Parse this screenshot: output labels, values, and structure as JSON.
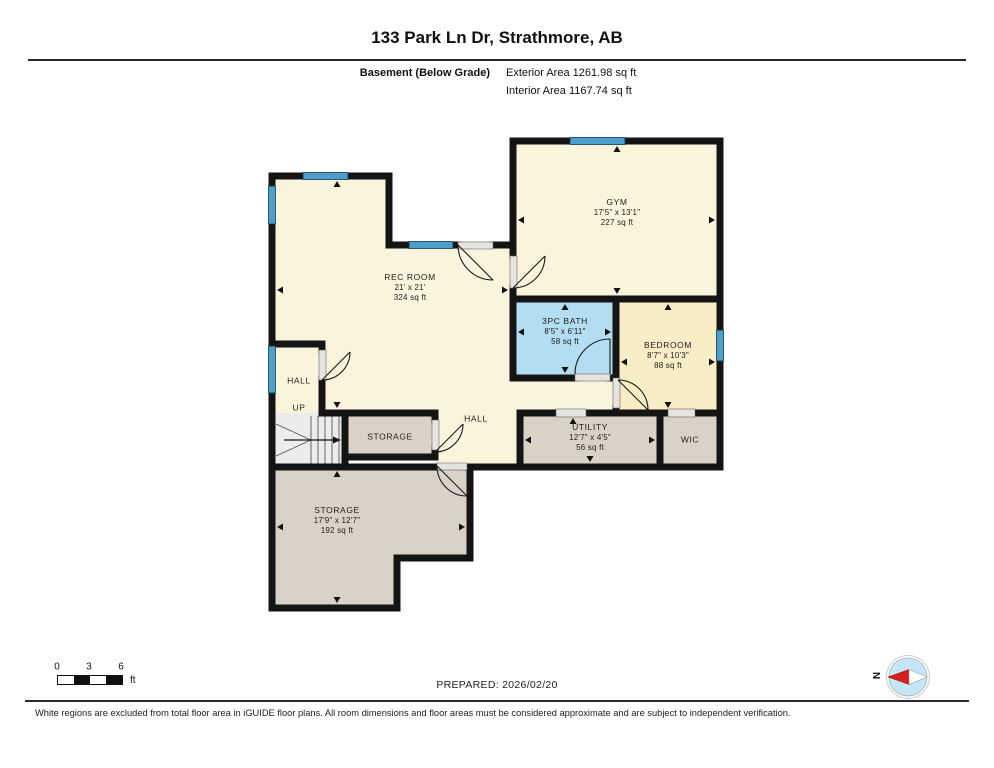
{
  "header": {
    "title": "133 Park Ln Dr, Strathmore, AB",
    "floor_label": "Basement (Below Grade)",
    "exterior_area": "Exterior Area 1261.98 sq ft",
    "interior_area": "Interior Area 1167.74 sq ft"
  },
  "rooms": {
    "gym": {
      "name": "GYM",
      "dims": "17'5\" x 13'1\"",
      "area": "227 sq ft"
    },
    "rec_room": {
      "name": "REC ROOM",
      "dims": "21' x 21'",
      "area": "324 sq ft"
    },
    "bath": {
      "name": "3PC BATH",
      "dims": "8'5\" x 6'11\"",
      "area": "58 sq ft"
    },
    "bedroom": {
      "name": "BEDROOM",
      "dims": "8'7\" x 10'3\"",
      "area": "88 sq ft"
    },
    "utility": {
      "name": "UTILITY",
      "dims": "12'7\" x 4'5\"",
      "area": "56 sq ft"
    },
    "wic": {
      "name": "WIC"
    },
    "hall_left": {
      "name": "HALL"
    },
    "up": {
      "name": "UP"
    },
    "hall_center": {
      "name": "HALL"
    },
    "storage_small": {
      "name": "STORAGE"
    },
    "storage_big": {
      "name": "STORAGE",
      "dims": "17'9\" x 12'7\"",
      "area": "192 sq ft"
    }
  },
  "footer": {
    "scale": {
      "t0": "0",
      "t3": "3",
      "t6": "6",
      "unit": "ft"
    },
    "prepared": "PREPARED: 2026/02/20",
    "compass_n": "N",
    "disclaimer": "White regions are excluded from total floor area in iGUIDE floor plans. All room dimensions and floor areas must be considered approximate and are subject to independent verification."
  },
  "colors": {
    "wall": "#141414",
    "room_cream": "#faf4dc",
    "room_bedroom": "#f9edc6",
    "room_bath": "#b3def2",
    "room_gray": "#d9d3c7",
    "stairs": "#ececea",
    "window_blue": "#4d9ecb",
    "compass_fill": "#c6e6f6",
    "compass_needle": "#d42020"
  }
}
